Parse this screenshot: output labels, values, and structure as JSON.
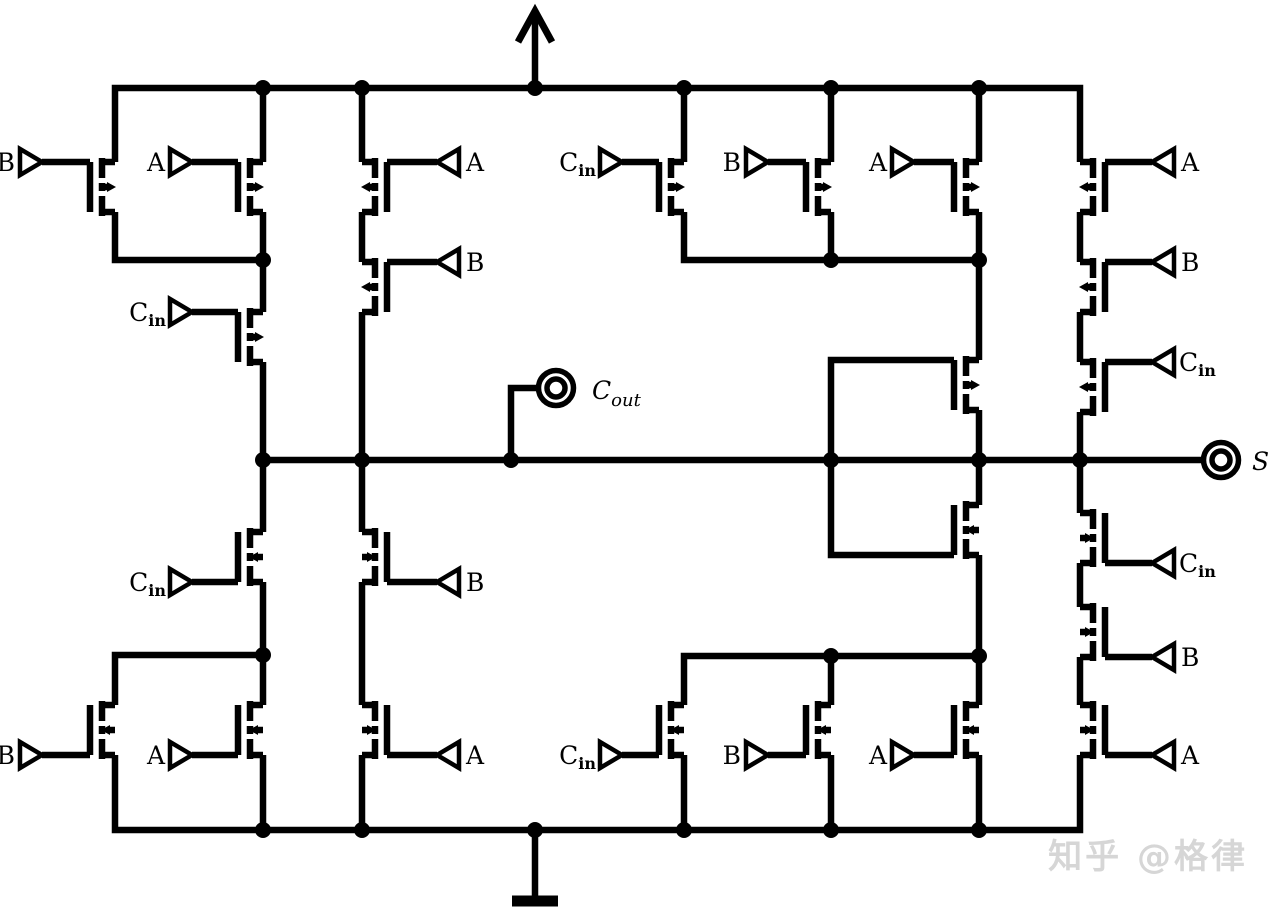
{
  "diagram_type": "Transistor-level CMOS full adder schematic (24-transistor mirror adder)",
  "colors": {
    "ink": "#000000",
    "background": "#ffffff",
    "watermark": "#d6d6d6"
  },
  "labels": {
    "a": "A",
    "b": "B",
    "c": "C",
    "in_sub": "in",
    "out_sub": "out",
    "s": "S"
  },
  "watermark": "知乎 @格律",
  "power": {
    "vdd_symbol": "up-arrow",
    "gnd_symbol": "ground-bar"
  },
  "io": {
    "inputs": [
      "A",
      "B",
      "Cin"
    ],
    "outputs": [
      "Cout",
      "S"
    ]
  },
  "netlist": {
    "carry_stage": {
      "pullup": {
        "parallel_pair": [
          "B",
          "A"
        ],
        "series_gate": "Cin",
        "bypass_series": [
          "A",
          "B"
        ]
      },
      "pulldown": {
        "series_gate": "Cin",
        "parallel_pair": [
          "B",
          "A"
        ],
        "bypass_series": [
          "B",
          "A"
        ]
      }
    },
    "sum_stage": {
      "pullup": {
        "parallel_triple": [
          "Cin",
          "B",
          "A"
        ],
        "inner_gate": "Cout_node",
        "series_chain": [
          "A",
          "B",
          "Cin"
        ]
      },
      "pulldown": {
        "inner_gate": "Cout_node",
        "parallel_triple": [
          "Cin",
          "B",
          "A"
        ],
        "series_chain": [
          "Cin",
          "B",
          "A"
        ]
      }
    }
  }
}
